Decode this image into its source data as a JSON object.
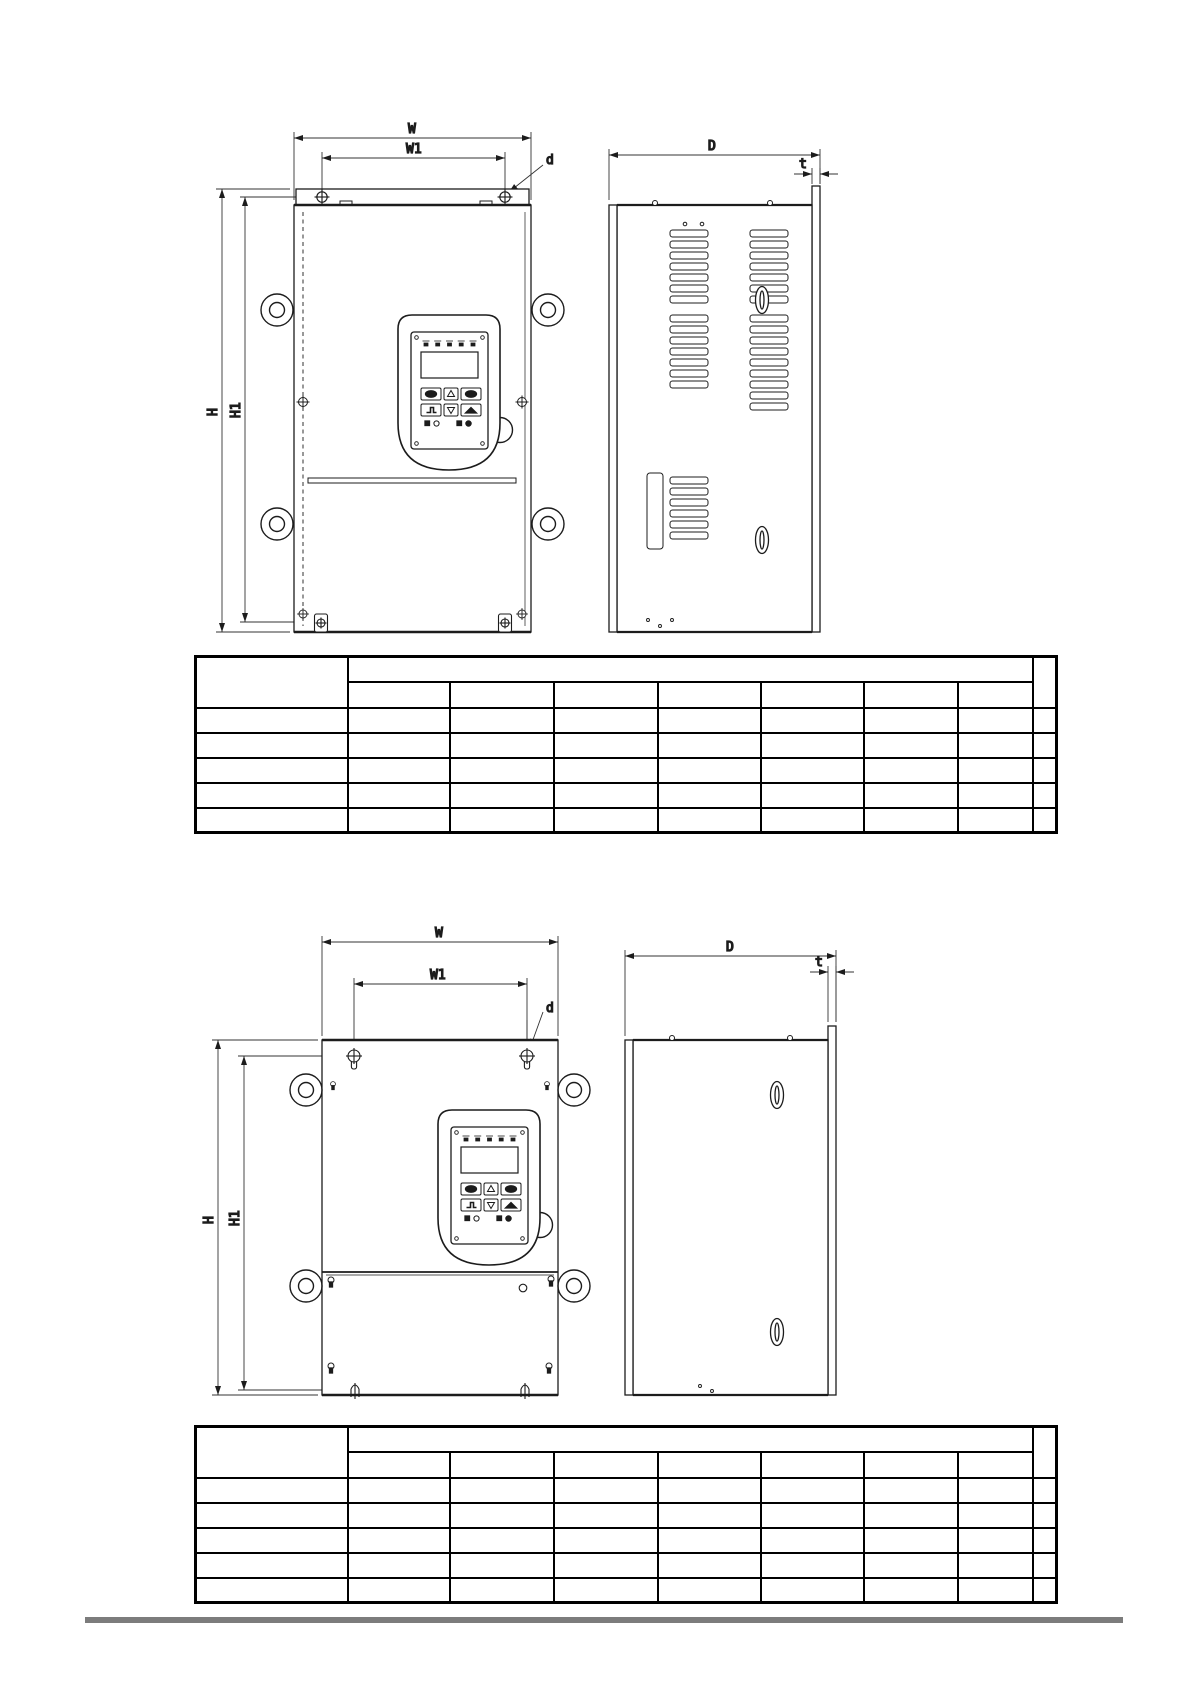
{
  "page": {
    "kind": "technical manual page - inverter dimension drawings",
    "background": "#ffffff",
    "footer_rule_color": "#7c7c7c",
    "line_color": "#1c1c1c"
  },
  "drawings": {
    "top": {
      "description": "dimension drawing, chassis with louvered side vents: front view and side view",
      "labels": {
        "W": "W",
        "W1": "W1",
        "H": "H",
        "H1": "H1",
        "D": "D",
        "d": "d",
        "t": "t"
      }
    },
    "bottom": {
      "description": "dimension drawing, plain-side chassis: front view and side view",
      "labels": {
        "W": "W",
        "W1": "W1",
        "H": "H",
        "H1": "H1",
        "D": "D",
        "d": "d",
        "t": "t"
      }
    }
  },
  "tables": [
    {
      "header": {
        "first": "",
        "group": "",
        "sub": [
          "",
          "",
          "",
          "",
          "",
          "",
          ""
        ],
        "last": ""
      },
      "rows": [
        [
          "",
          "",
          "",
          "",
          "",
          "",
          "",
          "",
          ""
        ],
        [
          "",
          "",
          "",
          "",
          "",
          "",
          "",
          "",
          ""
        ],
        [
          "",
          "",
          "",
          "",
          "",
          "",
          "",
          "",
          ""
        ],
        [
          "",
          "",
          "",
          "",
          "",
          "",
          "",
          "",
          ""
        ],
        [
          "",
          "",
          "",
          "",
          "",
          "",
          "",
          "",
          ""
        ]
      ]
    },
    {
      "header": {
        "first": "",
        "group": "",
        "sub": [
          "",
          "",
          "",
          "",
          "",
          "",
          ""
        ],
        "last": ""
      },
      "rows": [
        [
          "",
          "",
          "",
          "",
          "",
          "",
          "",
          "",
          ""
        ],
        [
          "",
          "",
          "",
          "",
          "",
          "",
          "",
          "",
          ""
        ],
        [
          "",
          "",
          "",
          "",
          "",
          "",
          "",
          "",
          ""
        ],
        [
          "",
          "",
          "",
          "",
          "",
          "",
          "",
          "",
          ""
        ],
        [
          "",
          "",
          "",
          "",
          "",
          "",
          "",
          "",
          ""
        ]
      ]
    }
  ]
}
